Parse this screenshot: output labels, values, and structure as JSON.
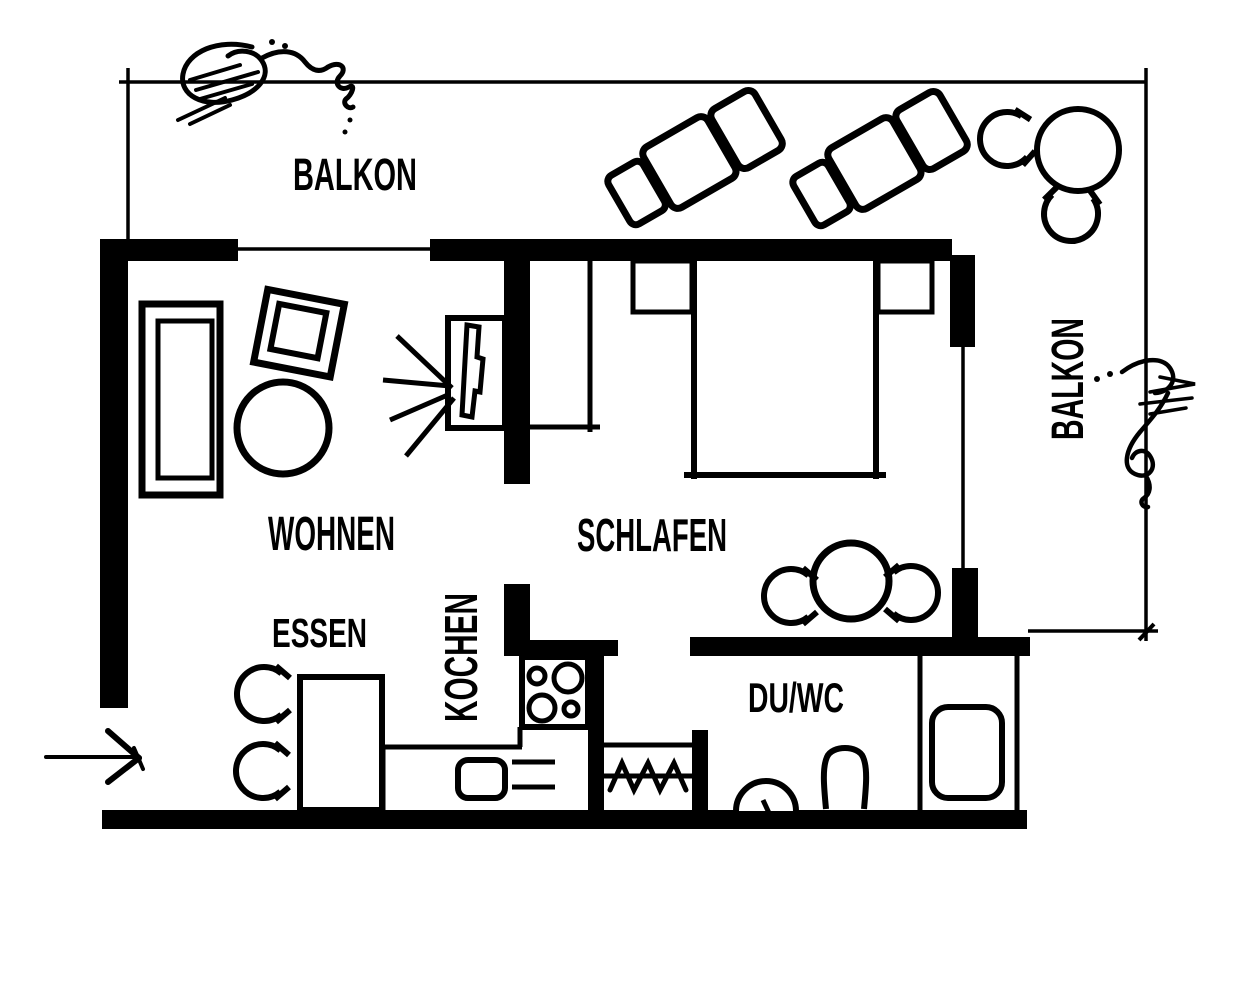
{
  "colors": {
    "ink": "#000000",
    "background": "#ffffff"
  },
  "labels": {
    "balkon_top": "BALKON",
    "balkon_right": "BALKON",
    "wohnen": "WOHNEN",
    "schlafen": "SCHLAFEN",
    "essen": "ESSEN",
    "kochen": "KOCHEN",
    "duwc": "DU/WC"
  }
}
